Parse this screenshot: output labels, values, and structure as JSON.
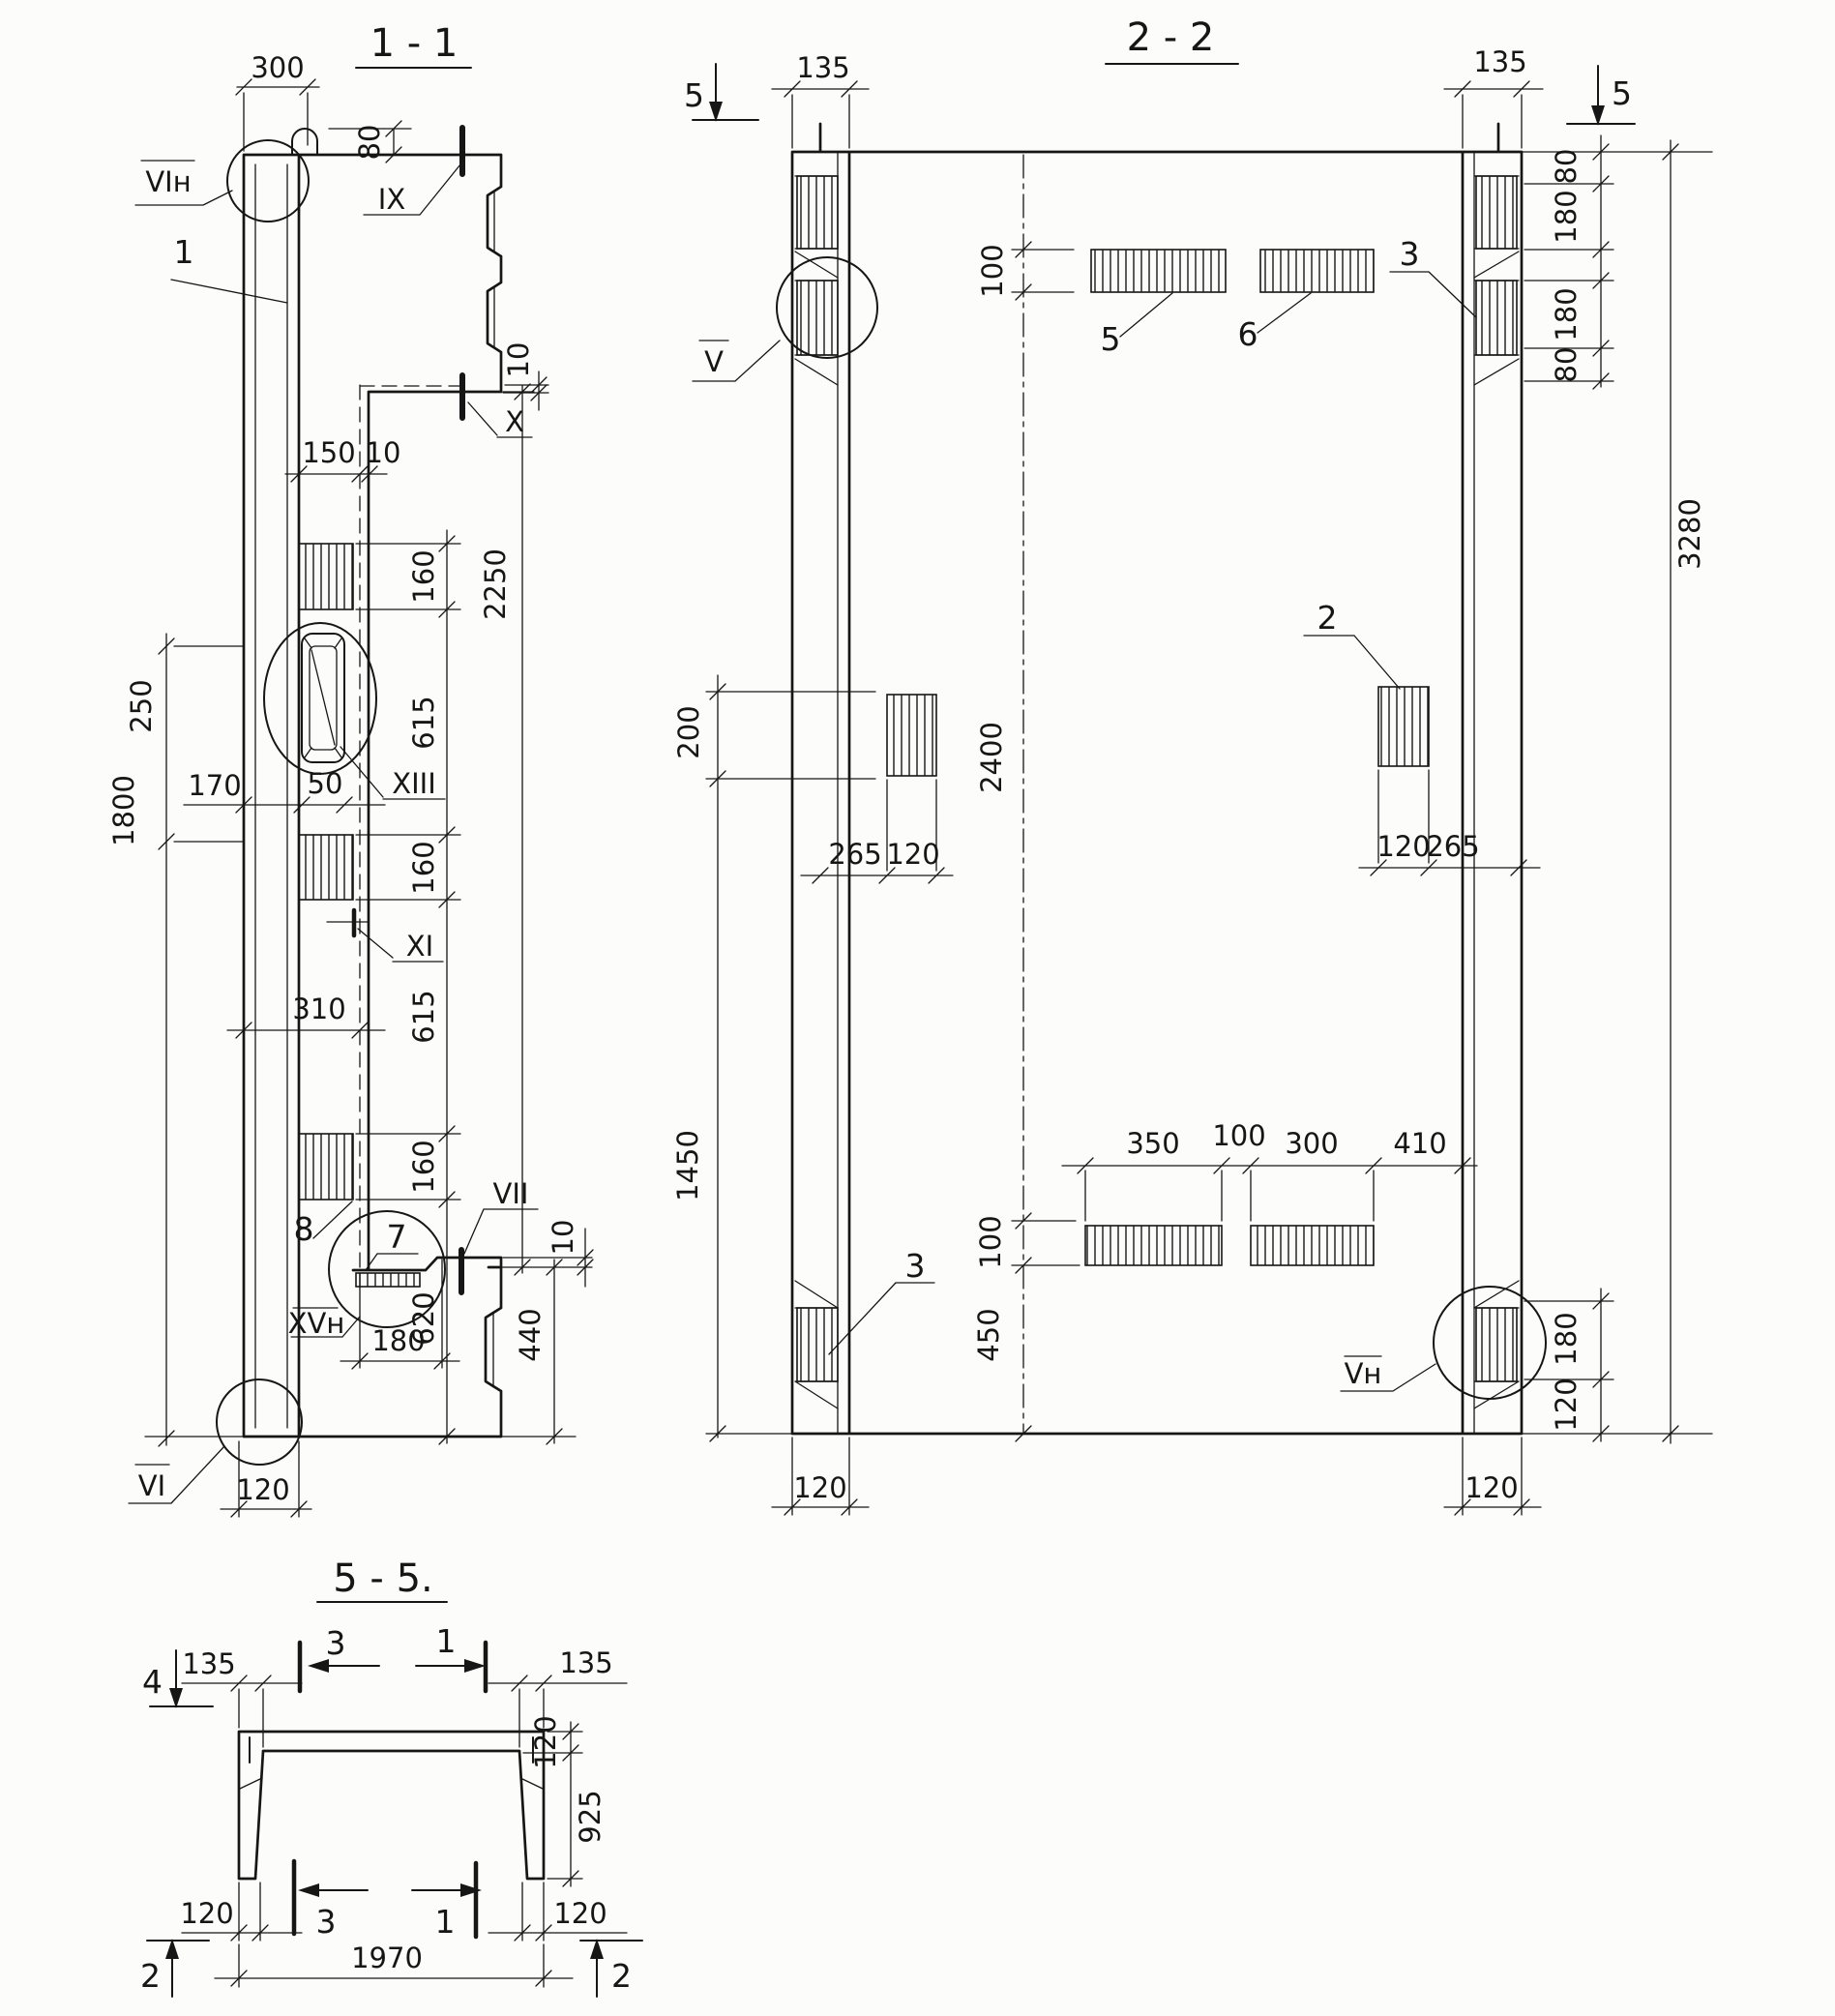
{
  "s11": {
    "title": "1 - 1",
    "callouts": {
      "c1": "1",
      "c7": "7",
      "c8": "8"
    },
    "details": {
      "vi_n": "VIн",
      "xiii": "XIII",
      "xv_n": "XVн",
      "vi": "VI"
    },
    "marks": {
      "ix": "IX",
      "x": "X",
      "xi": "XI",
      "vii": "VII"
    },
    "dims": {
      "d300": "300",
      "d80": "80",
      "d10_top": "10",
      "d150": "150",
      "d10_ledge": "10",
      "d160a": "160",
      "d615a": "615",
      "d160b": "160",
      "d615b": "615",
      "d160c": "160",
      "d2250": "2250",
      "d250": "250",
      "d170": "170",
      "d50": "50",
      "d310": "310",
      "d1800": "1800",
      "d180": "180",
      "d620": "620",
      "d440": "440",
      "d10_br": "10",
      "d120": "120"
    }
  },
  "s22": {
    "title": "2 - 2",
    "section_marks": {
      "s5_left": "5",
      "s5_right": "5"
    },
    "callouts": {
      "c5": "5",
      "c6": "6",
      "c3_top": "3",
      "c2": "2",
      "c3_bottom": "3"
    },
    "details": {
      "v": "V",
      "v_n": "Vн"
    },
    "dims": {
      "d135_left": "135",
      "d135_right": "135",
      "d80a": "80",
      "d180a": "180",
      "d180b": "180",
      "d80b": "80",
      "d3280": "3280",
      "d100_top": "100",
      "d200": "200",
      "d2400": "2400",
      "d265_left": "265",
      "d120_left": "120",
      "d120_right": "120",
      "d265_right": "265",
      "d1450": "1450",
      "d350": "350",
      "d100_mid": "100",
      "d300": "300",
      "d410": "410",
      "d100_bot": "100",
      "d450": "450",
      "d180_r": "180",
      "d120_r": "120",
      "d120_bl": "120",
      "d120_br": "120"
    }
  },
  "s55": {
    "title": "5 - 5.",
    "section_marks": {
      "s4": "4",
      "s2_left": "2",
      "s2_right": "2",
      "s3_top": "3",
      "s1_top": "1",
      "s3_bottom": "3",
      "s1_bottom": "1"
    },
    "dims": {
      "d135_left": "135",
      "d135_right": "135",
      "d120_web": "120",
      "d925": "925",
      "d120_left": "120",
      "d120_right": "120",
      "d1970": "1970"
    }
  }
}
